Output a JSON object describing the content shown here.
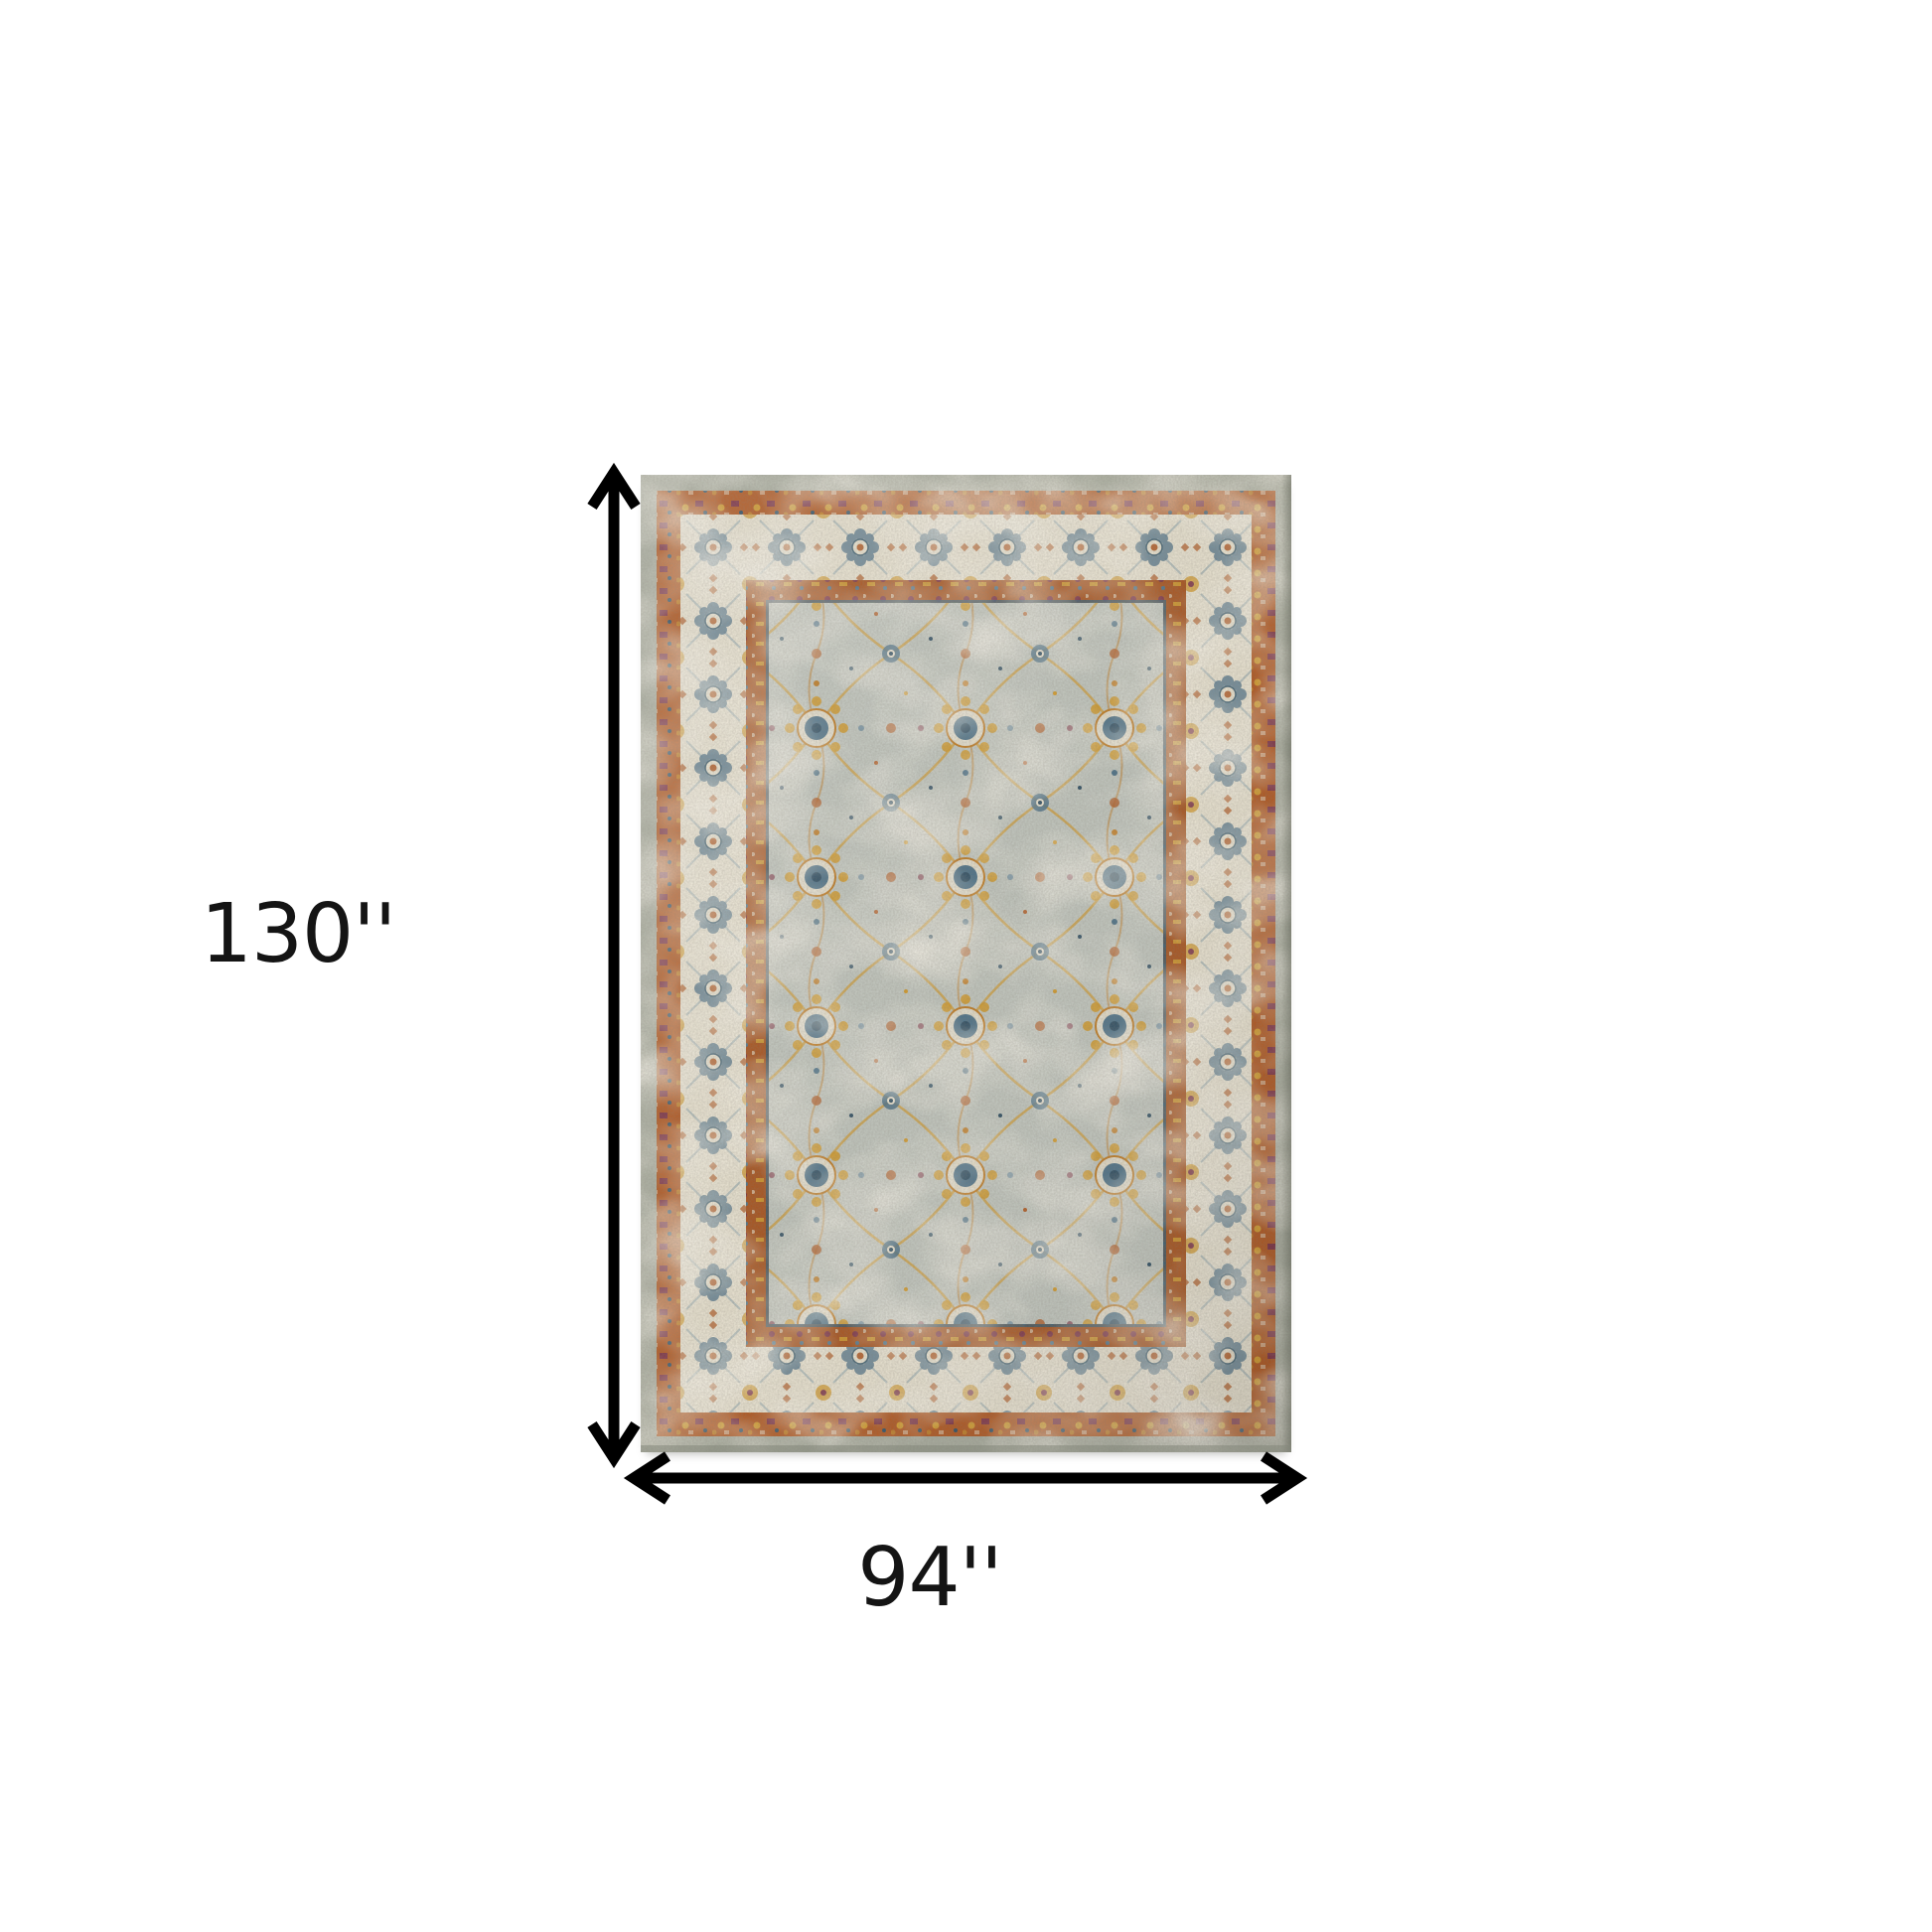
{
  "canvas": {
    "background": "#ffffff"
  },
  "labels": {
    "height": "130''",
    "width": "94''"
  },
  "icons": {
    "height_arrow": "vertical-double-headed-arrow",
    "width_arrow": "horizontal-double-headed-arrow"
  },
  "colors": {
    "arrow": "#000000",
    "label_text": "#141414",
    "outer_band": "#a9ad9f",
    "outer_band_shadow": "#6f7365",
    "rust_border": "#b0561f",
    "ivory_border": "#e9e3d1",
    "inner_rust_band": "#a8541f",
    "navy_frame": "#35586c",
    "field": "#c2c7bf",
    "field_light": "#ddd8c6",
    "gold": "#d29a2c",
    "amber": "#c07c24",
    "blue": "#4e7288",
    "blue_light": "#7e98a6",
    "navy": "#2d4d62",
    "rust": "#b05a23",
    "maroon": "#7b2f42",
    "cream": "#e8e2d0"
  }
}
